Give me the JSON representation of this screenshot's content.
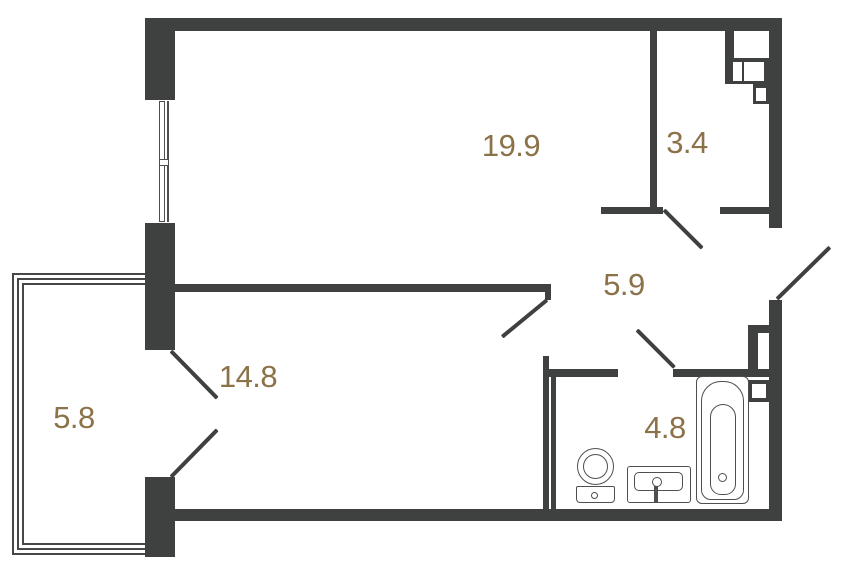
{
  "plan": {
    "type": "apartment-floor-plan",
    "rooms": [
      {
        "name": "living-room",
        "area": "19.9"
      },
      {
        "name": "storage",
        "area": "3.4"
      },
      {
        "name": "hallway",
        "area": "5.9"
      },
      {
        "name": "bedroom",
        "area": "14.8"
      },
      {
        "name": "balcony",
        "area": "5.8"
      },
      {
        "name": "bathroom",
        "area": "4.8"
      }
    ],
    "fixtures": [
      "bathtub-icon",
      "toilet-icon",
      "sink-icon",
      "water-heater-icon",
      "window-icon",
      "door-swing-icon"
    ],
    "colors": {
      "wall": "#3f4040",
      "label": "#8b7249",
      "fixture": "#4f4f4f",
      "glazing": "#474747",
      "background": "#ffffff"
    }
  }
}
